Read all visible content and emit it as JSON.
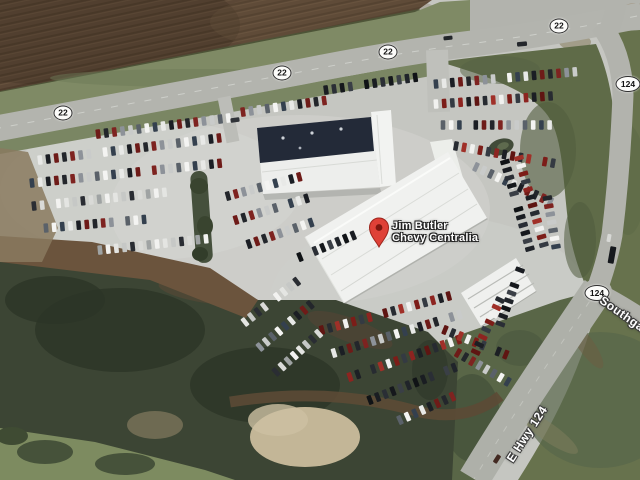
{
  "map": {
    "view_type": "satellite",
    "marker": {
      "line1": "Jim Butler",
      "line2": "Chevy Centralia",
      "x": 379,
      "y": 247,
      "label_x": 392,
      "label_y": 220,
      "pin_color": "#df4137",
      "pin_border": "#9d241b",
      "pin_dot_color": "#7e170f"
    },
    "route_shields": [
      {
        "label": "22",
        "x": 63,
        "y": 113
      },
      {
        "label": "22",
        "x": 282,
        "y": 73
      },
      {
        "label": "22",
        "x": 388,
        "y": 52
      },
      {
        "label": "22",
        "x": 559,
        "y": 26
      },
      {
        "label": "124",
        "x": 628,
        "y": 84
      },
      {
        "label": "124",
        "x": 597,
        "y": 293
      }
    ],
    "road_labels": [
      {
        "text": "Southgate",
        "x": 601,
        "y": 299,
        "angle": 35,
        "anchor": "left"
      },
      {
        "text": "E Hwy 124",
        "x": 527,
        "y": 434,
        "angle": -57,
        "anchor": "center"
      }
    ],
    "car_palettes": {
      "mixed": [
        "#1b1e24",
        "#f4f4f2",
        "#8d9299",
        "#6e1b18",
        "#34404e",
        "#c9cbca",
        "#23262b",
        "#e8e9e7",
        "#5a6169",
        "#7e2320"
      ],
      "dark": [
        "#1a1d22",
        "#2a2e35",
        "#15181c",
        "#3a3f46",
        "#20242a",
        "#101316"
      ],
      "red": [
        "#7c1d18",
        "#272b31",
        "#8d2420",
        "#f1f1ef",
        "#5f1512",
        "#343a42",
        "#a03028",
        "#1c1f24"
      ],
      "white": [
        "#f2f2f0",
        "#e4e5e2",
        "#c6c8c6",
        "#2a2d33",
        "#d9dad7",
        "#9fa3a3"
      ]
    },
    "car_rows": [
      [
        90,
        135,
        -7,
        18,
        "mixed"
      ],
      [
        40,
        160,
        -7,
        23,
        "mixed"
      ],
      [
        32,
        183,
        -6,
        24,
        "mixed"
      ],
      [
        34,
        206,
        -6,
        17,
        "white"
      ],
      [
        46,
        228,
        -5,
        13,
        "mixed"
      ],
      [
        100,
        250,
        -6,
        14,
        "white"
      ],
      [
        326,
        90,
        -8,
        12,
        "dark"
      ],
      [
        243,
        112,
        -8,
        11,
        "mixed"
      ],
      [
        228,
        196,
        -15,
        10,
        "mixed"
      ],
      [
        236,
        220,
        -17,
        10,
        "mixed"
      ],
      [
        249,
        244,
        -19,
        9,
        "mixed"
      ],
      [
        300,
        257,
        -22,
        8,
        "dark"
      ],
      [
        436,
        84,
        -5,
        18,
        "mixed"
      ],
      [
        436,
        104,
        -4,
        16,
        "red"
      ],
      [
        443,
        125,
        0,
        14,
        "mixed"
      ],
      [
        456,
        146,
        10,
        13,
        "red"
      ],
      [
        476,
        167,
        25,
        11,
        "mixed"
      ],
      [
        505,
        162,
        74,
        12,
        "dark"
      ],
      [
        519,
        158,
        74,
        12,
        "red"
      ],
      [
        546,
        190,
        80,
        8,
        "mixed"
      ],
      [
        322,
        330,
        -15,
        17,
        "red"
      ],
      [
        334,
        353,
        -17,
        17,
        "mixed"
      ],
      [
        350,
        377,
        -19,
        15,
        "red"
      ],
      [
        370,
        400,
        -21,
        12,
        "dark"
      ],
      [
        400,
        420,
        -24,
        8,
        "mixed"
      ],
      [
        245,
        322,
        -38,
        9,
        "white"
      ],
      [
        260,
        347,
        -40,
        9,
        "mixed"
      ],
      [
        276,
        372,
        -42,
        8,
        "white"
      ],
      [
        445,
        330,
        22,
        9,
        "red"
      ],
      [
        458,
        353,
        30,
        8,
        "mixed"
      ],
      [
        520,
        270,
        110,
        8,
        "dark"
      ],
      [
        500,
        300,
        115,
        8,
        "red"
      ]
    ],
    "vehicles": [
      [
        522,
        44,
        -5,
        10,
        4.5,
        "#24272c"
      ],
      [
        448,
        38,
        -6,
        9,
        4,
        "#23262a"
      ],
      [
        612,
        255,
        100,
        17,
        6,
        "#16191d"
      ],
      [
        609,
        238,
        100,
        8,
        4,
        "#d8d9d6"
      ],
      [
        497,
        459,
        -58,
        9,
        4.5,
        "#432a22"
      ],
      [
        235,
        120,
        -8,
        9,
        4.5,
        "#303338"
      ]
    ]
  }
}
